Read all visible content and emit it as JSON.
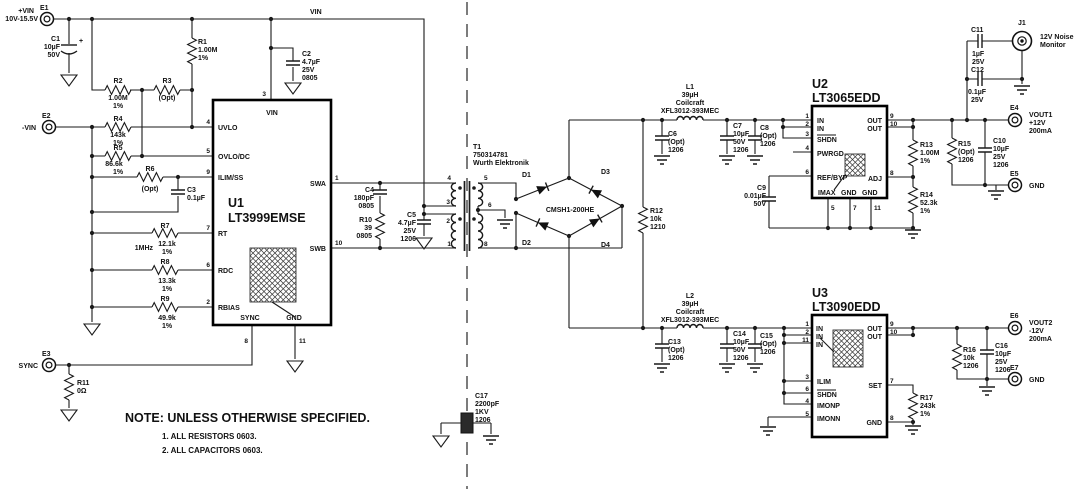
{
  "nets": {
    "vin": "VIN",
    "freq": "1MHz"
  },
  "terminals": {
    "e1": {
      "ref": "E1",
      "net": "+VIN",
      "range": "10V-15.5V"
    },
    "e2": {
      "ref": "E2",
      "net": "-VIN"
    },
    "e3": {
      "ref": "E3",
      "net": "SYNC"
    },
    "e4": {
      "ref": "E4",
      "l1": "VOUT1",
      "l2": "+12V",
      "l3": "200mA"
    },
    "e5": {
      "ref": "E5",
      "net": "GND"
    },
    "e6": {
      "ref": "E6",
      "l1": "VOUT2",
      "l2": "-12V",
      "l3": "200mA"
    },
    "e7": {
      "ref": "E7",
      "net": "GND"
    },
    "j1": {
      "ref": "J1",
      "l1": "12V Noise",
      "l2": "Monitor"
    }
  },
  "ics": {
    "u1": {
      "ref": "U1",
      "part": "LT3999EMSE",
      "pins": {
        "vin": {
          "n": "3",
          "l": "VIN"
        },
        "uvlo": {
          "n": "4",
          "l": "UVLO"
        },
        "ovlo": {
          "n": "5",
          "l": "OVLO/DC"
        },
        "ilimss": {
          "n": "9",
          "l": "ILIM/SS"
        },
        "rt": {
          "n": "7",
          "l": "RT"
        },
        "rdc": {
          "n": "6",
          "l": "RDC"
        },
        "rbias": {
          "n": "2",
          "l": "RBIAS"
        },
        "sync": {
          "n": "8",
          "l": "SYNC"
        },
        "gnd": {
          "n": "11",
          "l": "GND"
        },
        "swa": {
          "n": "1",
          "l": "SWA"
        },
        "swb": {
          "n": "10",
          "l": "SWB"
        }
      }
    },
    "u2": {
      "ref": "U2",
      "part": "LT3065EDD",
      "pins": {
        "in1": {
          "n": "1",
          "l": "IN"
        },
        "in2": {
          "n": "2",
          "l": "IN"
        },
        "shdn": {
          "n": "3",
          "l": "SHDN"
        },
        "pwrgd": {
          "n": "4",
          "l": "PWRGD"
        },
        "refbyp": {
          "n": "6",
          "l": "REF/BYP"
        },
        "imax": {
          "n": "5",
          "l": "IMAX"
        },
        "gnd1": {
          "n": "7",
          "l": "GND"
        },
        "gnd2": {
          "n": "11",
          "l": "GND"
        },
        "out1": {
          "n": "9",
          "l": "OUT"
        },
        "out2": {
          "n": "10",
          "l": "OUT"
        },
        "adj": {
          "n": "8",
          "l": "ADJ"
        }
      }
    },
    "u3": {
      "ref": "U3",
      "part": "LT3090EDD",
      "pins": {
        "in1": {
          "n": "1",
          "l": "IN"
        },
        "in2": {
          "n": "2",
          "l": "IN"
        },
        "in3": {
          "n": "11",
          "l": "IN"
        },
        "ilim": {
          "n": "3",
          "l": "ILIM"
        },
        "shdn": {
          "n": "6",
          "l": "SHDN"
        },
        "imonp": {
          "n": "4",
          "l": "IMONP"
        },
        "imonn": {
          "n": "5",
          "l": "IMONN"
        },
        "out1": {
          "n": "9",
          "l": "OUT"
        },
        "out2": {
          "n": "10",
          "l": "OUT"
        },
        "set": {
          "n": "7",
          "l": "SET"
        },
        "gnd": {
          "n": "8",
          "l": "GND"
        }
      }
    }
  },
  "transformer": {
    "labels": [
      "T1",
      "750314781",
      "Wurth Elektronik"
    ],
    "pins": {
      "p4": "4",
      "p3": "3",
      "p2": "2",
      "p1": "1",
      "p5": "5",
      "p6": "6",
      "p8": "8"
    }
  },
  "bridge": {
    "part": "CMSH1-200HE",
    "d1": "D1",
    "d2": "D2",
    "d3": "D3",
    "d4": "D4"
  },
  "components": {
    "c1": {
      "labels": [
        "C1",
        "10µF",
        "50V"
      ],
      "plus": "+"
    },
    "c2": {
      "labels": [
        "C2",
        "4.7µF",
        "25V",
        "0805"
      ]
    },
    "c3": {
      "labels": [
        "C3",
        "0.1µF"
      ]
    },
    "c4": {
      "labels": [
        "C4",
        "180pF",
        "0805"
      ]
    },
    "c5": {
      "labels": [
        "C5",
        "4.7µF",
        "25V",
        "1206"
      ]
    },
    "c6": {
      "labels": [
        "C6",
        "(Opt)",
        "1206"
      ]
    },
    "c7": {
      "labels": [
        "C7",
        "10µF",
        "50V",
        "1206"
      ]
    },
    "c8": {
      "labels": [
        "C8",
        "(Opt)",
        "1206"
      ]
    },
    "c9": {
      "labels": [
        "C9",
        "0.01µF",
        "50V"
      ]
    },
    "c10": {
      "labels": [
        "C10",
        "10µF",
        "25V",
        "1206"
      ]
    },
    "c11": {
      "labels": [
        "C11",
        "1µF",
        "25V"
      ]
    },
    "c12": {
      "labels": [
        "C12",
        "0.1µF",
        "25V"
      ]
    },
    "c13": {
      "labels": [
        "C13",
        "(Opt)",
        "1206"
      ]
    },
    "c14": {
      "labels": [
        "C14",
        "10µF",
        "50V",
        "1206"
      ]
    },
    "c15": {
      "labels": [
        "C15",
        "(Opt)",
        "1206"
      ]
    },
    "c16": {
      "labels": [
        "C16",
        "10µF",
        "25V",
        "1206"
      ]
    },
    "c17": {
      "labels": [
        "C17",
        "2200pF",
        "1KV",
        "1206"
      ]
    },
    "r1": {
      "labels": [
        "R1",
        "1.00M",
        "1%"
      ]
    },
    "r2": {
      "labels": [
        "R2",
        "1.00M",
        "1%"
      ]
    },
    "r3": {
      "labels": [
        "R3",
        "(Opt)"
      ]
    },
    "r4": {
      "labels": [
        "R4",
        "143k",
        "1%"
      ]
    },
    "r5": {
      "labels": [
        "R5",
        "86.6k",
        "1%"
      ]
    },
    "r6": {
      "labels": [
        "R6",
        "(Opt)"
      ]
    },
    "r7": {
      "labels": [
        "R7",
        "12.1k",
        "1%"
      ]
    },
    "r8": {
      "labels": [
        "R8",
        "13.3k",
        "1%"
      ]
    },
    "r9": {
      "labels": [
        "R9",
        "49.9k",
        "1%"
      ]
    },
    "r10": {
      "labels": [
        "R10",
        "39",
        "0805"
      ]
    },
    "r11": {
      "labels": [
        "R11",
        "0Ω"
      ]
    },
    "r12": {
      "labels": [
        "R12",
        "10k",
        "1210"
      ]
    },
    "r13": {
      "labels": [
        "R13",
        "1.00M",
        "1%"
      ]
    },
    "r14": {
      "labels": [
        "R14",
        "52.3k",
        "1%"
      ]
    },
    "r15": {
      "labels": [
        "R15",
        "(Opt)",
        "1206"
      ]
    },
    "r16": {
      "labels": [
        "R16",
        "10k",
        "1206"
      ]
    },
    "r17": {
      "labels": [
        "R17",
        "243k",
        "1%"
      ]
    },
    "l1": {
      "labels": [
        "L1",
        "39µH",
        "Coilcraft",
        "XFL3012-393MEC"
      ]
    },
    "l2": {
      "labels": [
        "L2",
        "39µH",
        "Coilcraft",
        "XFL3012-393MEC"
      ]
    }
  },
  "note": {
    "heading": "NOTE: UNLESS OTHERWISE SPECIFIED.",
    "items": [
      "1. ALL RESISTORS 0603.",
      "2. ALL CAPACITORS 0603."
    ]
  }
}
